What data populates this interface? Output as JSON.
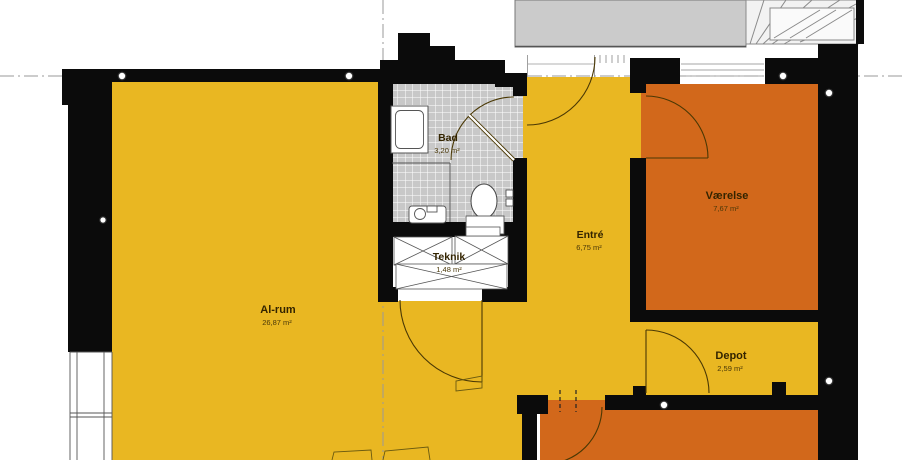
{
  "rooms": [
    {
      "name": "Al-rum",
      "area": "26,87 m²"
    },
    {
      "name": "Bad",
      "area": "3,20 m²"
    },
    {
      "name": "Teknik",
      "area": "1,48 m²"
    },
    {
      "name": "Entré",
      "area": "6,75 m²"
    },
    {
      "name": "Værelse",
      "area": "7,67 m²"
    },
    {
      "name": "Depot",
      "area": "2,59 m²"
    }
  ],
  "colors": {
    "room_yellow": "#e9b722",
    "room_orange": "#d2681b",
    "wall_black": "#0b0b0b",
    "bath_tile_gray": "#c8c8c8",
    "deck_gray": "#cbcbcb",
    "door_arc_brown": "#4a3804",
    "reference_line_gray": "#9a9a9a"
  }
}
